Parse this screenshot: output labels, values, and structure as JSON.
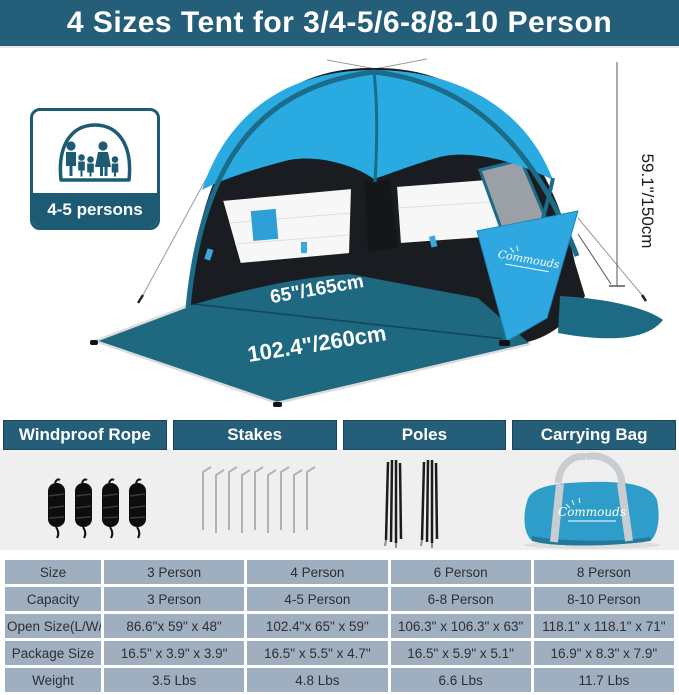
{
  "banner": {
    "title": "4 Sizes Tent for 3/4-5/6-8/8-10 Person"
  },
  "brand": "Commouds",
  "tent": {
    "persons_label": "4-5 persons",
    "width_label": "65\"/165cm",
    "depth_label": "102.4\"/260cm",
    "height_label": "59.1\"/150cm"
  },
  "accessories": [
    {
      "title": "Windproof Rope"
    },
    {
      "title": "Stakes"
    },
    {
      "title": "Poles"
    },
    {
      "title": "Carrying Bag"
    }
  ],
  "colors": {
    "banner_teal": "#245e78",
    "tent_blue": "#29abe2",
    "floor_teal": "#1e6880",
    "table_cell_gray_blue": "#9fafc0",
    "bag_blue": "#2f9dc9"
  },
  "spec_table": {
    "rows": [
      {
        "label": "Size",
        "values": [
          "3 Person",
          "4 Person",
          "6 Person",
          "8 Person"
        ]
      },
      {
        "label": "Capacity",
        "values": [
          "3 Person",
          "4-5 Person",
          "6-8 Person",
          "8-10 Person"
        ]
      },
      {
        "label": "Open Size(L/W/H)",
        "values": [
          "86.6\"x 59\" x 48\"",
          "102.4\"x 65\" x 59\"",
          "106.3\" x 106.3\" x 63\"",
          "118.1\" x 118.1\" x 71\""
        ]
      },
      {
        "label": "Package Size",
        "values": [
          "16.5\" x 3.9\" x 3.9\"",
          "16.5\" x 5.5\" x 4.7\"",
          "16.5\" x 5.9\" x 5.1\"",
          "16.9\" x 8.3\" x 7.9\""
        ]
      },
      {
        "label": "Weight",
        "values": [
          "3.5 Lbs",
          "4.8 Lbs",
          "6.6 Lbs",
          "11.7 Lbs"
        ]
      }
    ]
  }
}
